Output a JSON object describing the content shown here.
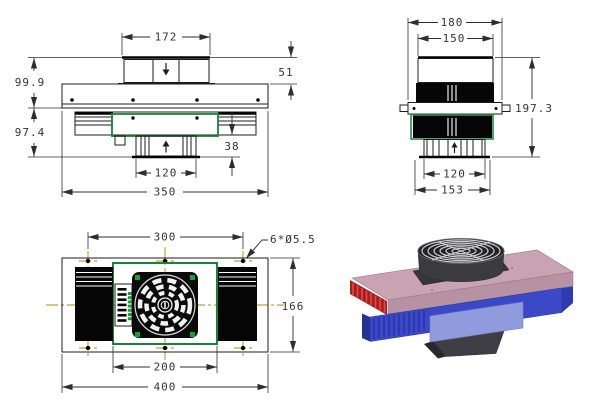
{
  "front_view": {
    "dims": {
      "fan_width": "172",
      "fan_height": "51",
      "upper_height": "99.9",
      "lower_height": "97.4",
      "outlet_height": "38",
      "outlet_width": "120",
      "overall_width": "350"
    }
  },
  "side_view": {
    "dims": {
      "flange_width": "180",
      "fan_width": "150",
      "overall_height": "197.3",
      "outlet_width": "120",
      "base_width": "153"
    }
  },
  "plan_view": {
    "dims": {
      "hole_spacing": "300",
      "hole_callout": "6*Ø5.5",
      "depth": "166",
      "cold_block_width": "200",
      "overall_length": "400"
    }
  },
  "colors": {
    "drawing_line": "#1c1c1c",
    "dimension_line": "#2e2e2e",
    "green_outline": "#18823c",
    "centerline_orange": "#b8860b",
    "render_hot_plate_pink": "#c9a3b2",
    "render_fins_red": "#c03030",
    "render_tec_strip_cyan": "#2fa3b0",
    "render_cold_body_blue": "#3b49c9",
    "render_front_panel_periwinkle": "#8f9bdc",
    "render_fan_dark_gray": "#3a3a3f",
    "render_guard_silver": "#cfcfd2"
  }
}
